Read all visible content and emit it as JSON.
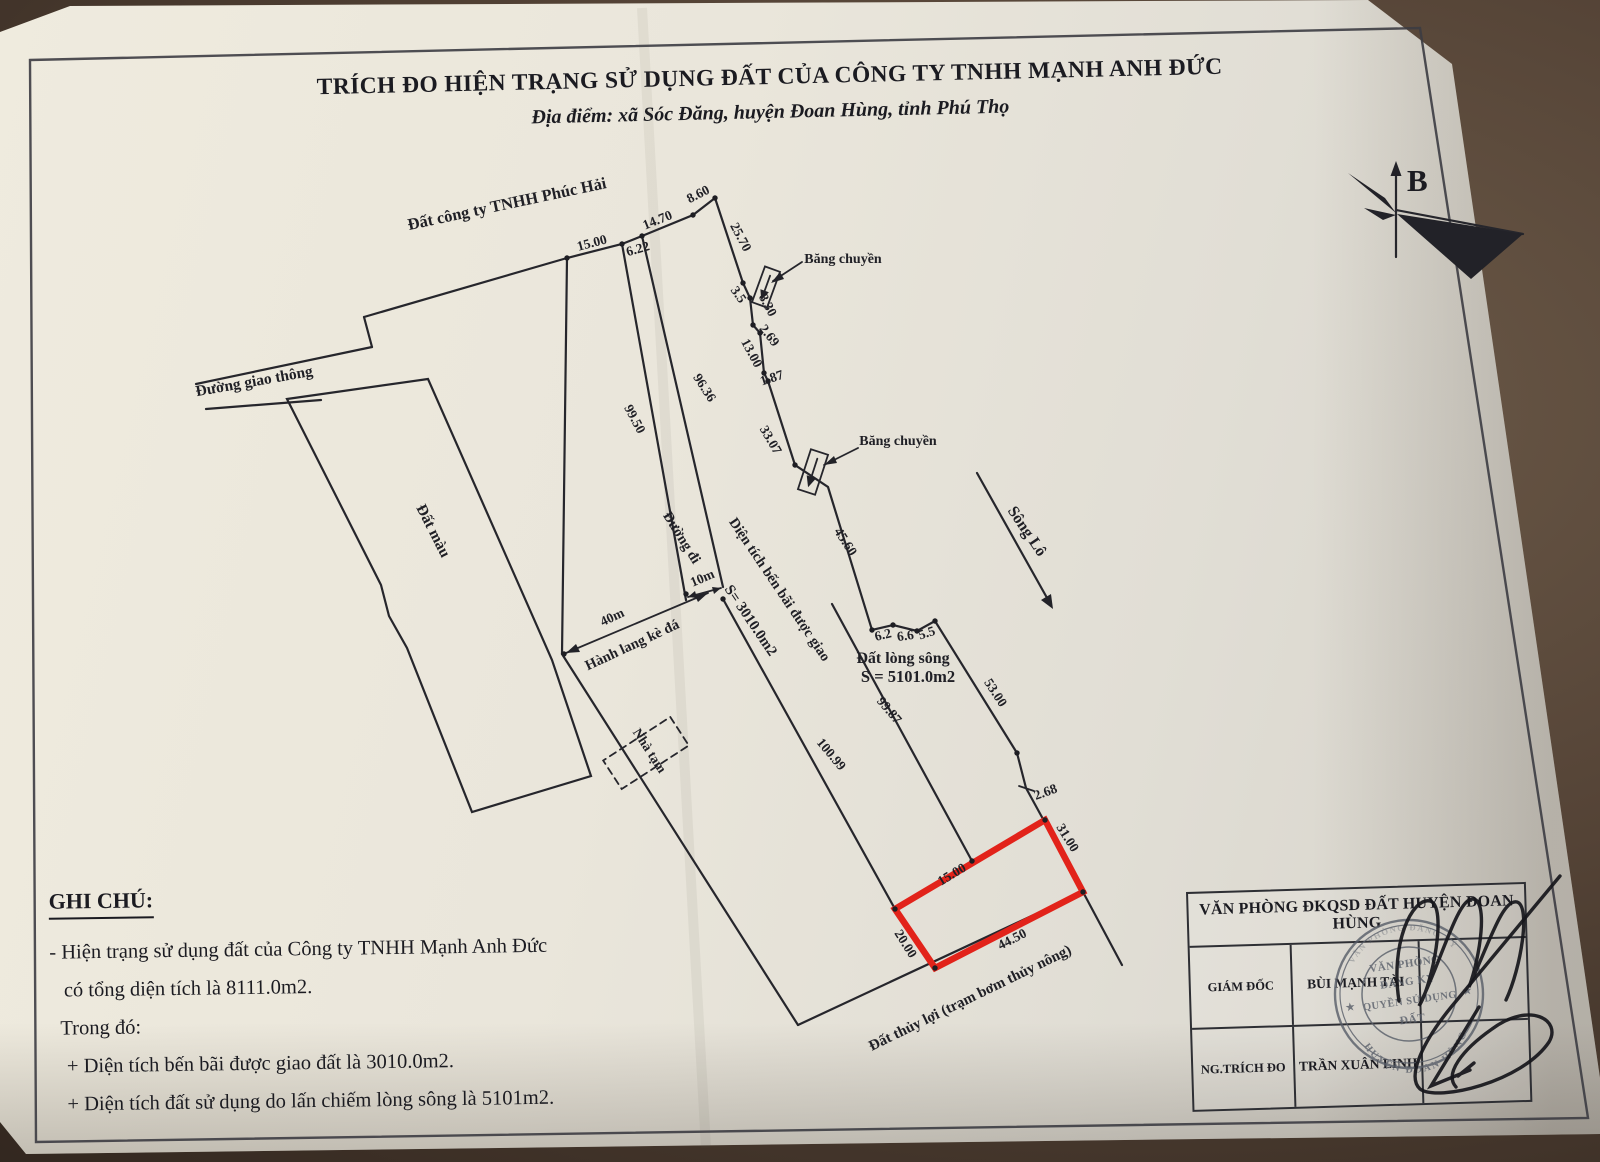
{
  "page": {
    "title": "TRÍCH ĐO HIỆN TRẠNG SỬ DỤNG ĐẤT CỦA CÔNG TY TNHH MẠNH ANH ĐỨC",
    "subtitle": "Địa điểm: xã Sóc Đăng, huyện Đoan Hùng, tỉnh Phú Thọ"
  },
  "compass": {
    "north_label": "B"
  },
  "map": {
    "highlight_color": "#e2231a",
    "area_labels": [
      {
        "id": "label-dat-cong-ty-phuc-hai",
        "text": "Đất công ty TNHH Phúc Hải",
        "x": 508,
        "y": 209,
        "rot": -12,
        "size": 16.5
      },
      {
        "id": "label-duong-giao-thong",
        "text": "Đường giao thông",
        "x": 255,
        "y": 386,
        "rot": -10,
        "size": 15.5
      },
      {
        "id": "label-dat-mau",
        "text": "Đất màu",
        "x": 429,
        "y": 533,
        "rot": 63,
        "size": 15.5
      },
      {
        "id": "label-duong-di",
        "text": "Đường đi",
        "x": 678,
        "y": 540,
        "rot": 58,
        "size": 14.5
      },
      {
        "id": "label-hanh-lang-ke-da",
        "text": "Hành lang kè đá",
        "x": 634,
        "y": 649,
        "rot": -25,
        "size": 14.5
      },
      {
        "id": "label-nha-tam",
        "text": "Nhà tạm",
        "x": 646,
        "y": 753,
        "rot": 57,
        "size": 13.5
      },
      {
        "id": "label-dien-tich-ben-bai",
        "text": "Diện tích bến bãi được giao",
        "x": 776,
        "y": 592,
        "rot": 56,
        "size": 14.5
      },
      {
        "id": "label-dien-tich-ben-bai-s",
        "text": "S= 3010.0m2",
        "x": 747,
        "y": 623,
        "rot": 56,
        "size": 15
      },
      {
        "id": "label-dat-long-song",
        "text": "Đất lòng sông",
        "x": 903,
        "y": 663,
        "rot": 0,
        "size": 16
      },
      {
        "id": "label-dat-long-song-s",
        "text": "S = 5101.0m2",
        "x": 908,
        "y": 682,
        "rot": 0,
        "size": 16.5
      },
      {
        "id": "label-song-lo",
        "text": "Sông Lô",
        "x": 1023,
        "y": 534,
        "rot": 56,
        "size": 16
      },
      {
        "id": "label-bang-chuyen-1",
        "text": "Băng chuyền",
        "x": 843,
        "y": 263,
        "rot": 0,
        "size": 14
      },
      {
        "id": "label-bang-chuyen-2",
        "text": "Băng chuyền",
        "x": 898,
        "y": 445,
        "rot": 0,
        "size": 14
      },
      {
        "id": "label-dat-thuy-loi",
        "text": "Đất thủy lợi (trạm bơm thủy nông)",
        "x": 972,
        "y": 1002,
        "rot": -26,
        "size": 15
      }
    ],
    "measurements": [
      {
        "text": "15.00",
        "x": 593,
        "y": 247,
        "rot": -15
      },
      {
        "text": "6.22",
        "x": 639,
        "y": 253,
        "rot": -16
      },
      {
        "text": "14.70",
        "x": 659,
        "y": 224,
        "rot": -22
      },
      {
        "text": "8.60",
        "x": 700,
        "y": 198,
        "rot": -27
      },
      {
        "text": "25.70",
        "x": 737,
        "y": 239,
        "rot": 62
      },
      {
        "text": "3.5",
        "x": 735,
        "y": 297,
        "rot": 55
      },
      {
        "text": "8.30",
        "x": 764,
        "y": 307,
        "rot": 62
      },
      {
        "text": "2.69",
        "x": 766,
        "y": 338,
        "rot": 52
      },
      {
        "text": "13.00",
        "x": 748,
        "y": 355,
        "rot": 62
      },
      {
        "text": "1.87",
        "x": 773,
        "y": 382,
        "rot": -18
      },
      {
        "text": "33.07",
        "x": 767,
        "y": 442,
        "rot": 60
      },
      {
        "text": "45.60",
        "x": 842,
        "y": 544,
        "rot": 57
      },
      {
        "text": "6.2",
        "x": 884,
        "y": 639,
        "rot": -14
      },
      {
        "text": "6.6",
        "x": 906,
        "y": 640,
        "rot": -8
      },
      {
        "text": "5.5",
        "x": 928,
        "y": 637,
        "rot": -18
      },
      {
        "text": "53.00",
        "x": 992,
        "y": 695,
        "rot": 57
      },
      {
        "text": "2.68",
        "x": 1047,
        "y": 796,
        "rot": -20
      },
      {
        "text": "31.00",
        "x": 1064,
        "y": 840,
        "rot": 58
      },
      {
        "text": "99.50",
        "x": 631,
        "y": 421,
        "rot": 62
      },
      {
        "text": "96.36",
        "x": 701,
        "y": 390,
        "rot": 57
      },
      {
        "text": "100.99",
        "x": 828,
        "y": 757,
        "rot": 50
      },
      {
        "text": "99.87",
        "x": 886,
        "y": 713,
        "rot": 50
      },
      {
        "text": "40m",
        "x": 614,
        "y": 621,
        "rot": -25
      },
      {
        "text": "10m",
        "x": 704,
        "y": 582,
        "rot": -23
      },
      {
        "text": "15.00",
        "x": 954,
        "y": 878,
        "rot": -31
      },
      {
        "text": "20.00",
        "x": 902,
        "y": 946,
        "rot": 58
      },
      {
        "text": "44.50",
        "x": 1014,
        "y": 943,
        "rot": -27
      }
    ]
  },
  "notes": {
    "heading": "GHI CHÚ:",
    "lines": [
      {
        "text": "- Hiện trạng sử dụng đất của Công ty TNHH Mạnh Anh Đức",
        "indent": 0
      },
      {
        "text": "có tổng diện tích là 8111.0m2.",
        "indent": 14
      },
      {
        "text": "Trong đó:",
        "indent": 10
      },
      {
        "text": "+ Diện tích bến bãi được giao đất là 3010.0m2.",
        "indent": 16
      },
      {
        "text": "+ Diện tích đất sử dụng do lấn chiếm lòng sông là 5101m2.",
        "indent": 16
      }
    ]
  },
  "title_block": {
    "header": "VĂN PHÒNG ĐKQSD ĐẤT HUYỆN ĐOAN HÙNG",
    "rows": [
      {
        "label": "GIÁM ĐỐC",
        "value": "BÙI MẠNH TÀI"
      },
      {
        "label": "NG.TRÍCH ĐO",
        "value": "TRẦN XUÂN LINH"
      }
    ]
  },
  "stamp": {
    "ring_top": "VĂN PHÒNG ĐĂNG KÝ",
    "ring_bottom": "HUYỆN ĐOAN HÙNG",
    "center_lines": [
      "VĂN PHÒNG",
      "ĐĂNG KÝ",
      "QUYỀN SỬ DỤNG",
      "ĐẤT"
    ]
  }
}
